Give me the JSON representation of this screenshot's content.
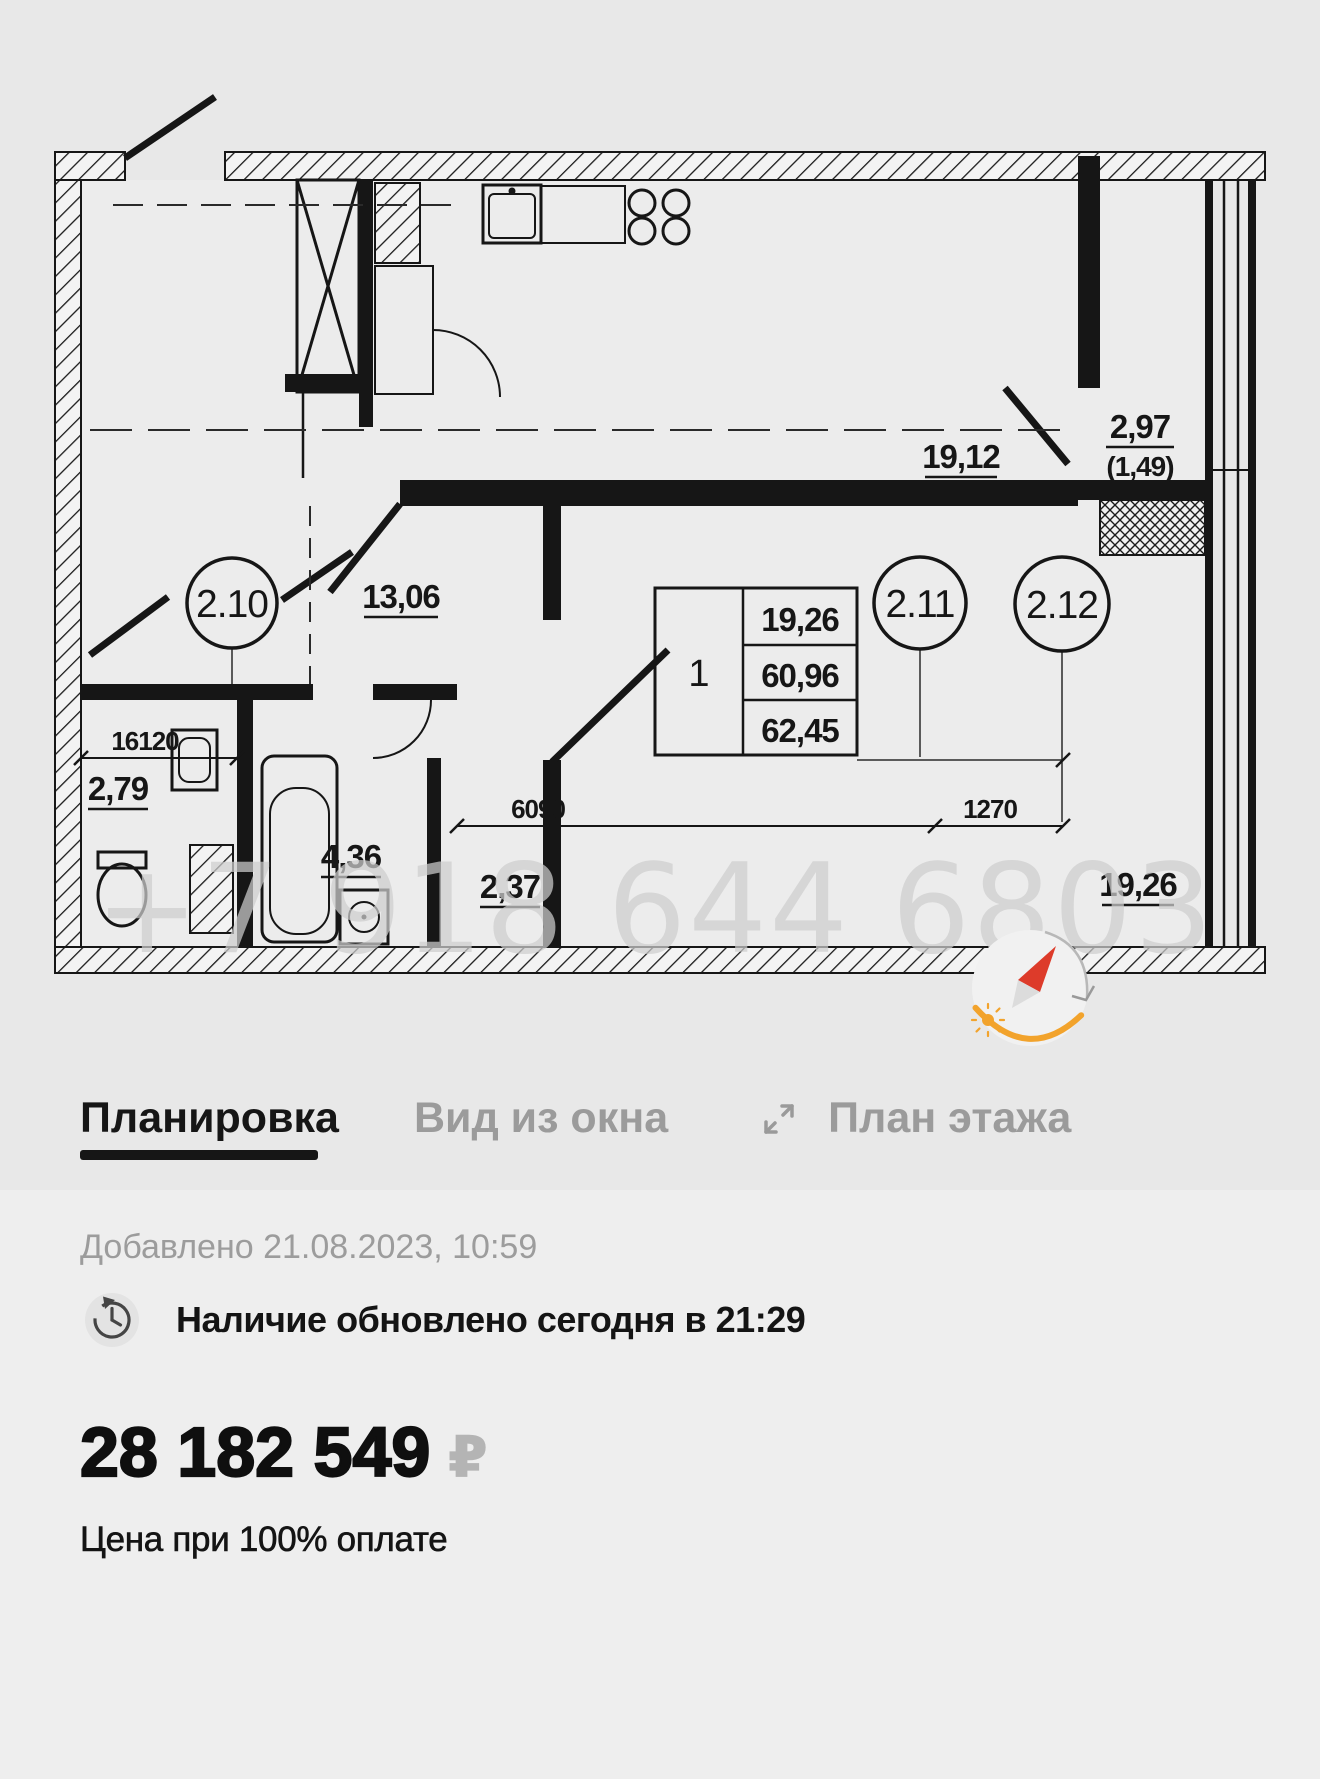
{
  "plan": {
    "watermark": "+7 918 644 6803",
    "labels": {
      "living_area": "19,12",
      "balcony_area": "2,97",
      "balcony_reduced": "(1,49)",
      "corridor_area": "13,06",
      "wc_area": "2,79",
      "bath_area": "4,36",
      "hall_area": "2,37",
      "bedroom_area": "19,26"
    },
    "axis_markers": [
      "2.10",
      "2.11",
      "2.12"
    ],
    "info_table": {
      "unit_number": "1",
      "row1": "19,26",
      "row2": "60,96",
      "row3": "62,45"
    },
    "dimensions": {
      "d1": "16120",
      "d2": "6090",
      "d3": "1270"
    }
  },
  "tabs": {
    "layout": "Планировка",
    "window_view": "Вид из окна",
    "floor_plan": "План этажа"
  },
  "listing": {
    "added": "Добавлено 21.08.2023, 10:59",
    "availability": "Наличие обновлено сегодня в 21:29",
    "price": "28 182 549",
    "currency": "₽",
    "price_note": "Цена при 100% оплате"
  },
  "colors": {
    "background": "#E8E8E8",
    "card_background": "#EEEEEE",
    "text_primary": "#161616",
    "text_muted": "#9B9B9B",
    "accent_orange": "#F2A32C",
    "needle_red": "#DD3B2A",
    "watermark_gray": "#CDCDCD"
  }
}
